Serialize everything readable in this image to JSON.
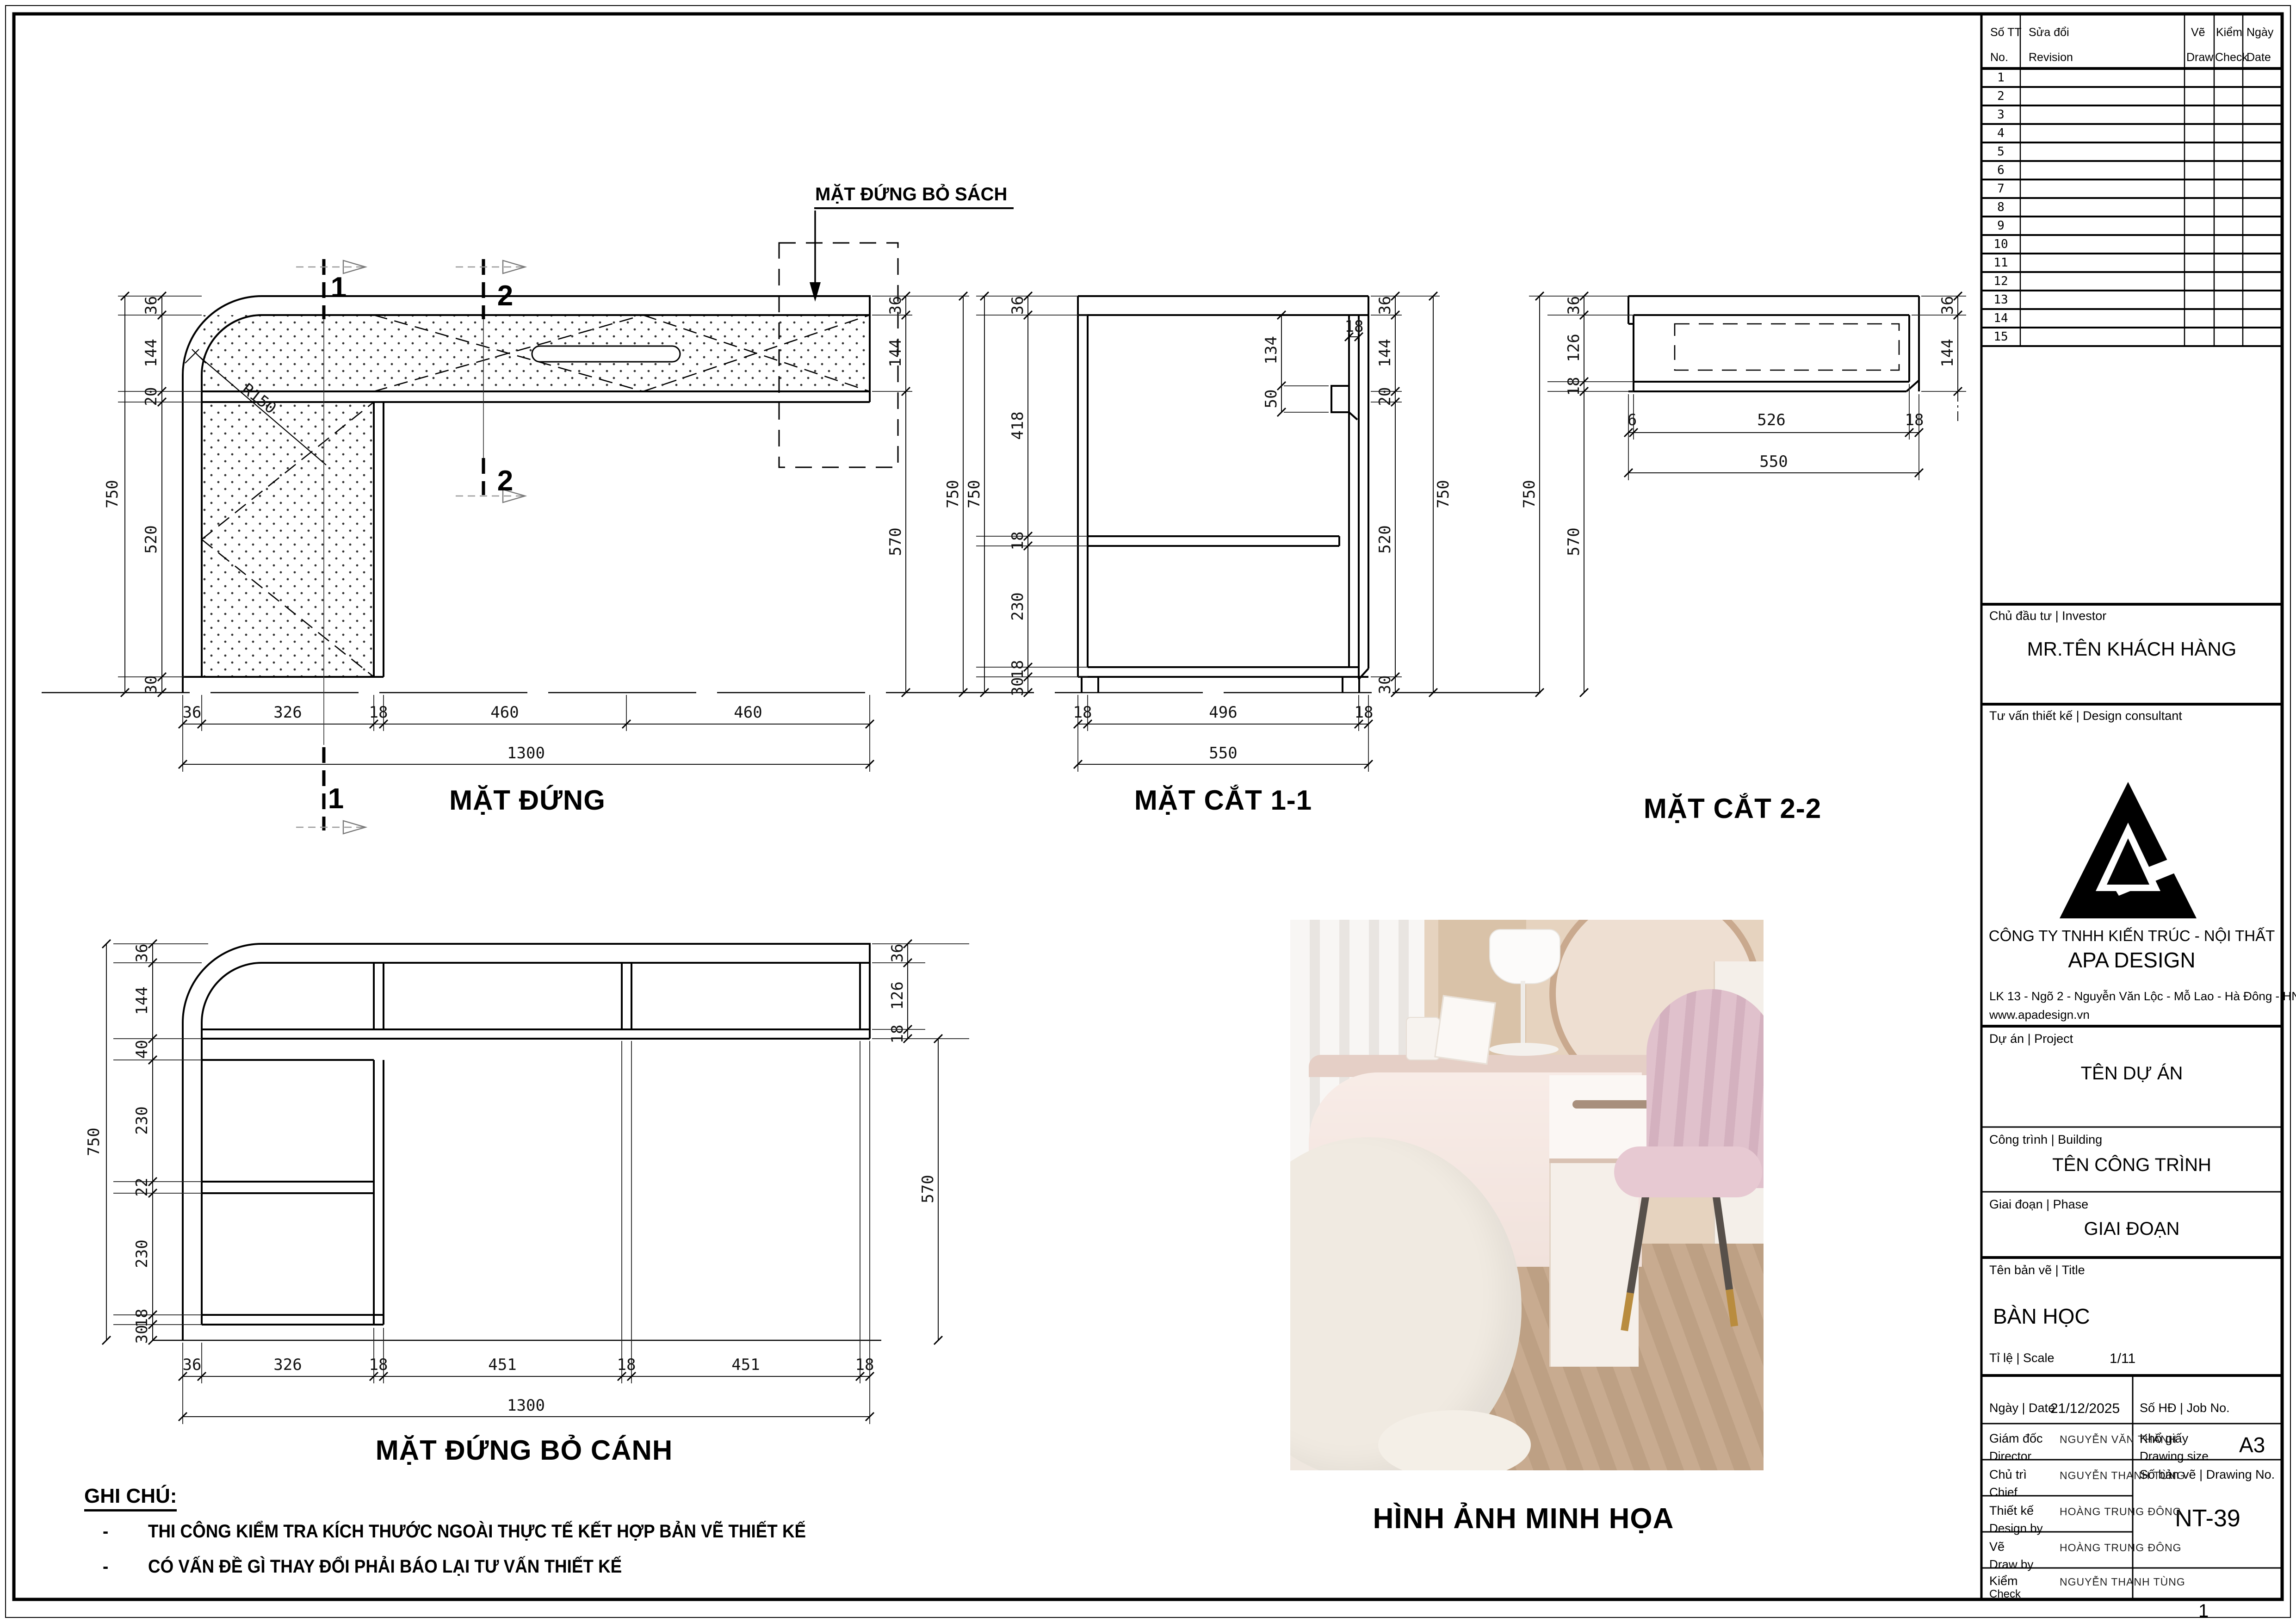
{
  "sheet": {
    "page_number": "1"
  },
  "revision_table": {
    "headers": {
      "no_vi": "Số TT",
      "no_en": "No.",
      "rev_vi": "Sửa đổi",
      "rev_en": "Revision",
      "draw_vi": "Vẽ",
      "draw_en": "Draw",
      "check_vi": "Kiểm",
      "check_en": "Check",
      "date_vi": "Ngày",
      "date_en": "Date"
    },
    "rows": [
      "1",
      "2",
      "3",
      "4",
      "5",
      "6",
      "7",
      "8",
      "9",
      "10",
      "11",
      "12",
      "13",
      "14",
      "15"
    ]
  },
  "title_block": {
    "investor_label": "Chủ đầu tư | Investor",
    "investor": "MR.TÊN KHÁCH HÀNG",
    "consultant_label": "Tư vấn thiết kế | Design consultant",
    "company_line1": "CÔNG TY TNHH KIẾN TRÚC - NỘI THẤT",
    "company_line2": "APA DESIGN",
    "address": "LK 13 - Ngõ 2 - Nguyễn Văn Lộc - Mỗ Lao - Hà Đông - HN",
    "website": "www.apadesign.vn",
    "project_label": "Dự án | Project",
    "project": "TÊN DỰ ÁN",
    "building_label": "Công trình | Building",
    "building": "TÊN CÔNG TRÌNH",
    "phase_label": "Giai đoạn | Phase",
    "phase": "GIAI ĐOẠN",
    "title_label": "Tên bản vẽ | Title",
    "drawing_title": "BÀN HỌC",
    "scale_label": "Tỉ lệ | Scale",
    "scale": "1/11",
    "date_label": "Ngày | Date",
    "date": "21/12/2025",
    "job_label": "Số HĐ | Job No.",
    "director_label": "Giám đốc",
    "director_en": "Director",
    "director": "NGUYỄN VĂN THÀNH",
    "paper_label": "Khổ giấy",
    "paper_en": "Drawing size",
    "paper": "A3",
    "chief_label": "Chủ trì",
    "chief_en": "Chief",
    "chief": "NGUYỄN THANH TÙNG",
    "dwgno_label": "Số bản vẽ | Drawing No.",
    "dwgno": "NT-39",
    "design_label": "Thiết kế",
    "design_en": "Design by",
    "designer": "HOÀNG TRUNG ĐÔNG",
    "draw_label": "Vẽ",
    "draw_en": "Draw by",
    "drawer": "HOÀNG TRUNG ĐÔNG",
    "check_label": "Kiểm",
    "check_en": "Check",
    "checker": "NGUYỄN THANH TÙNG"
  },
  "views": {
    "front": {
      "title": "MẶT ĐỨNG",
      "callout": "MẶT ĐỨNG BỎ SÁCH",
      "radius": "R150",
      "marker1": "1",
      "marker2": "2",
      "overall_left": "750",
      "dims_left": [
        "36",
        "144",
        "20",
        "520",
        "30"
      ],
      "dims_bottom": [
        "36",
        "326",
        "18",
        "460",
        "460"
      ],
      "overall_bottom": "1300",
      "dims_right": [
        "36",
        "144",
        "570"
      ],
      "overall_right": "750"
    },
    "section1": {
      "title": "MẶT CẮT 1-1",
      "overall_left": "750",
      "dims_left": [
        "36",
        "418",
        "18",
        "230",
        "18",
        "30"
      ],
      "dims_inner": [
        "134",
        "50",
        "18"
      ],
      "dims_right": [
        "36",
        "144",
        "20",
        "520",
        "30"
      ],
      "overall_right": "750",
      "dims_bottom": [
        "18",
        "496",
        "18"
      ],
      "overall_bottom": "550"
    },
    "section2": {
      "title": "MẶT CẮT 2-2",
      "overall_left": "750",
      "dims_left": [
        "36",
        "126",
        "18"
      ],
      "below_left": "570",
      "dims_bottom": [
        "6",
        "526",
        "18"
      ],
      "overall_bottom": "550",
      "dims_right": [
        "36",
        "144"
      ]
    },
    "open": {
      "title": "MẶT ĐỨNG BỎ CÁNH",
      "overall_left": "750",
      "dims_left": [
        "36",
        "144",
        "40",
        "230",
        "22",
        "230",
        "18",
        "30"
      ],
      "dims_bottom": [
        "36",
        "326",
        "18",
        "451",
        "18",
        "451",
        "18"
      ],
      "overall_bottom": "1300",
      "dims_right": [
        "36",
        "126",
        "18"
      ],
      "below_right": "570"
    }
  },
  "notes": {
    "heading": "GHI CHÚ:",
    "bullet": "-",
    "items": [
      "THI CÔNG KIỂM TRA KÍCH THƯỚC NGOÀI THỰC TẾ KẾT HỢP BẢN VẼ THIẾT KẾ",
      "CÓ VẤN ĐỀ GÌ THAY ĐỔI PHẢI BÁO LẠI TƯ VẤN THIẾT KẾ"
    ]
  },
  "photo": {
    "caption": "HÌNH ẢNH MINH HỌA"
  }
}
